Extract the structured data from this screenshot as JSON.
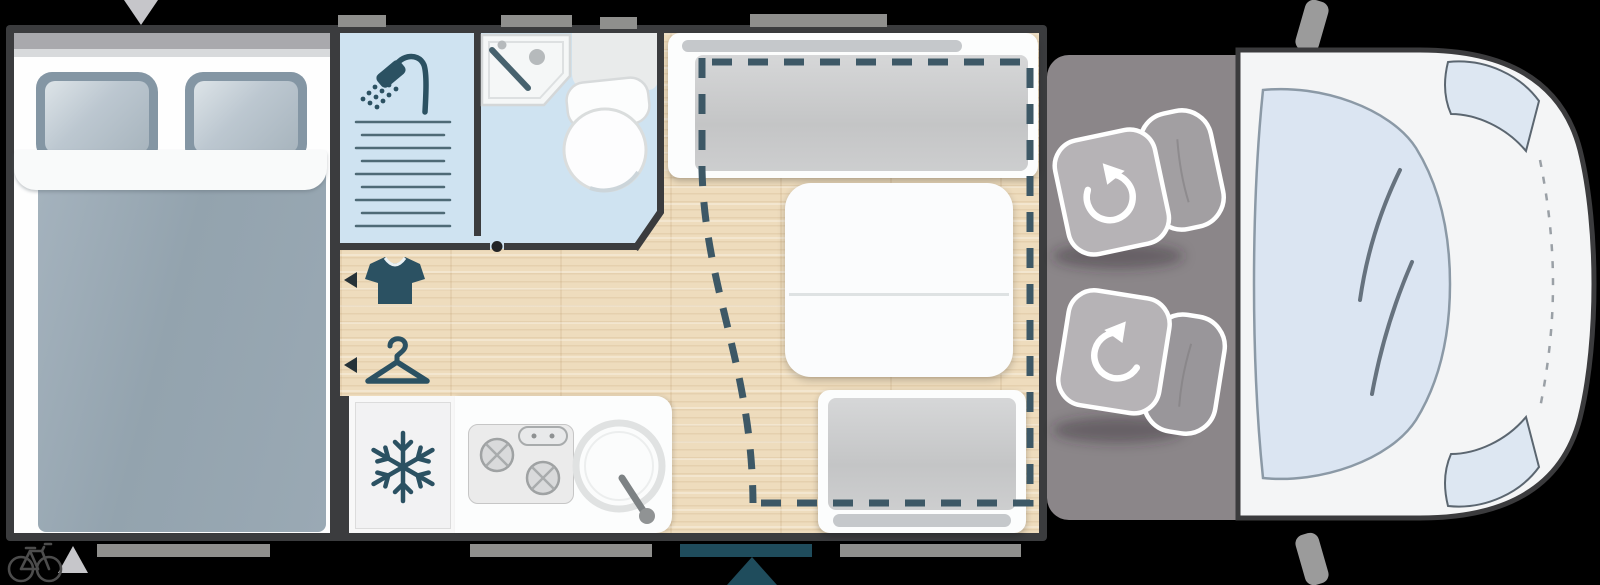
{
  "diagram": {
    "type": "motorhome-floor-plan",
    "orientation": "top-view, cab on the right, rear on the left",
    "visible_text": "none",
    "rooms": [
      {
        "name": "rear-bedroom",
        "furniture": [
          "double-bed",
          "pillow-left",
          "pillow-right",
          "duvet",
          "sheet-fold"
        ]
      },
      {
        "name": "bathroom",
        "furniture": [
          "shower-cabin",
          "drain-grate",
          "washbasin",
          "toilet"
        ],
        "icons": [
          "shower-icon"
        ]
      },
      {
        "name": "wardrobe-area",
        "icons": [
          "t-shirt-icon",
          "hanger-icon",
          "arrow-left-marker",
          "arrow-left-marker"
        ]
      },
      {
        "name": "kitchen",
        "furniture": [
          "refrigerator",
          "two-burner-stove",
          "round-sink"
        ],
        "icons": [
          "snowflake-icon"
        ]
      },
      {
        "name": "dinette",
        "furniture": [
          "bench-seat-front",
          "folding-table",
          "bench-seat-rear",
          "drop-down-bed-dashed-outline"
        ]
      },
      {
        "name": "cab",
        "furniture": [
          "swivel-seat-upper",
          "swivel-seat-lower"
        ],
        "icons": [
          "rotate-cw-icon",
          "rotate-ccw-icon"
        ]
      },
      {
        "name": "van-front",
        "features": [
          "windshield",
          "wipers",
          "headlight-upper",
          "headlight-lower",
          "side-mirror-upper",
          "side-mirror-lower",
          "hood-dashed-line"
        ]
      }
    ],
    "markers": {
      "entry_triangle_top_left": "points-down",
      "entry_triangle_bottom_left": "points-up",
      "entry_door_triangle_bottom_center": "points-up",
      "door_strip": "teal, bottom wall right of kitchen",
      "window_strips_top": 4,
      "window_strips_bottom": 3,
      "bike_icon": "bottom-left corner",
      "bathroom_door_pivot_dot": "bottom bathroom wall"
    },
    "colors": {
      "background": "#000000",
      "wall": "#3b3c3e",
      "wood_floor": "#eedcbd",
      "bathroom_blue": "#cfe3f1",
      "icon_petrol": "#2b5162",
      "dashed_bed_outline": "#3d5866",
      "bed_duvet": "#9aa9b4",
      "pillow": "#8496a4",
      "bench_cushion": "#c9cacb",
      "cab_floor": "#8b8689",
      "seat_gray": "#b6b3b6",
      "van_body": "#f4f5f6",
      "windshield": "#dbe5f2",
      "door_teal": "#1f4c5c",
      "window_strip": "#8f8f8d"
    }
  }
}
